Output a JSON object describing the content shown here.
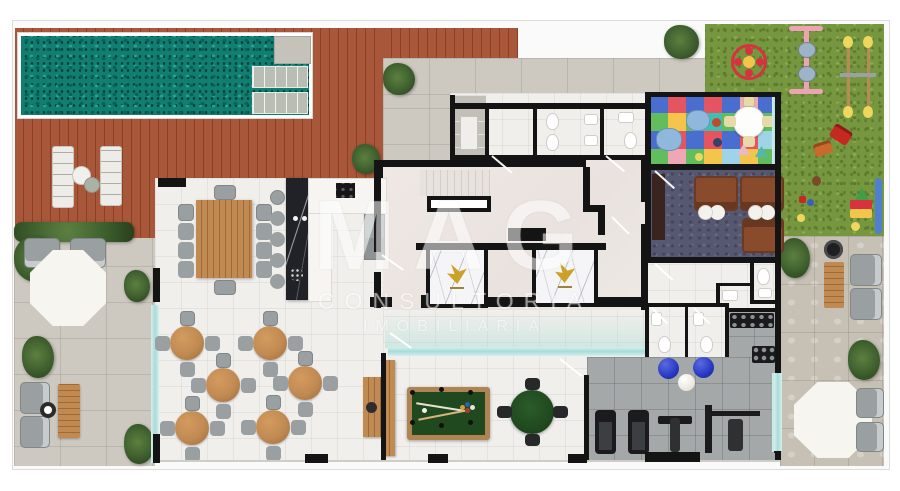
{
  "watermark": {
    "brand": "MAG",
    "line1": "CONSULTORIA",
    "line2": "IMOBILIÁRIA"
  },
  "palette": {
    "pool": "#107f72",
    "pool-dark": "#0a6157",
    "pool-light": "#2aa38f",
    "deck": "#a9573a",
    "deck-dark": "#8a4124",
    "lawn": "#76973f",
    "lawn-dark": "#5d7c2f",
    "lawn-light": "#8cab52",
    "patio": "#cdc9c1",
    "terrace": "#c7c1b5",
    "interior": "#f1efec",
    "wall": "#141414",
    "glass": "#a8dcd9",
    "glass-light": "#d6efed",
    "wood": "#c08a52",
    "wood-dark": "#9e6b38",
    "chair": "#9aa0a1",
    "chair-dark": "#7f8789",
    "felt": "#20491f",
    "felt-dark": "#173a16",
    "carpet": "#565770",
    "carpet-dark": "#45465d",
    "gym": "#a4a8a9",
    "sofa": "#8a4a2c",
    "sofa-dark": "#6b3a21",
    "equip": "#1b1b1d",
    "ball-blue": "#2838c4",
    "gold": "#c9a227",
    "kids-red": "#e55561",
    "kids-yellow": "#f4c54b",
    "kids-green": "#62bd5c",
    "kids-teal": "#3dbfb2",
    "kids-blue": "#4a6ed0",
    "kids-pink": "#f1a6b6",
    "kids-sky": "#9fd3e8",
    "plant": "#3e5f2e",
    "plant-dark": "#293f1d",
    "plant-light": "#5d8040"
  }
}
